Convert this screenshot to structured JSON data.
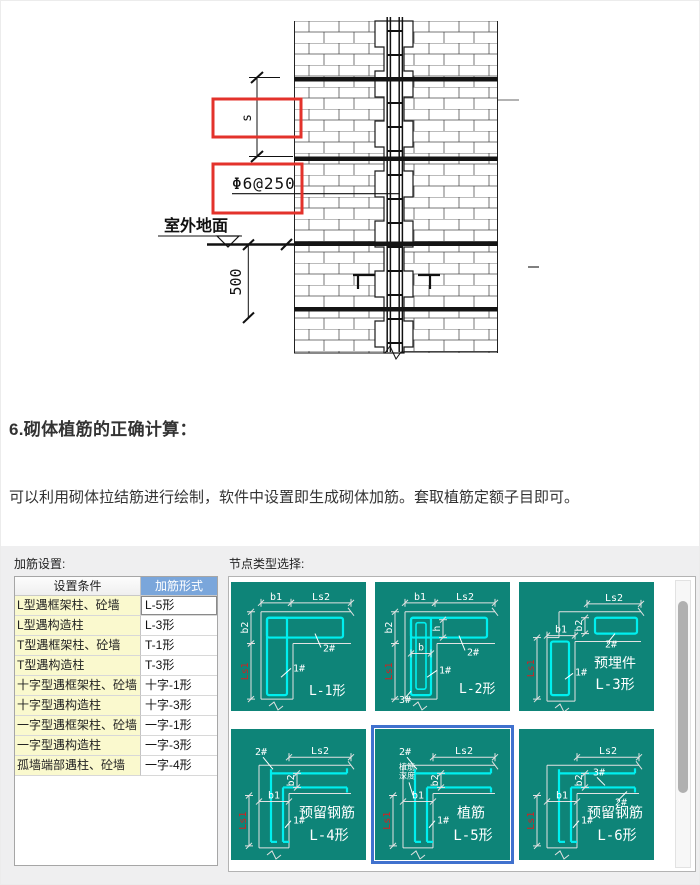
{
  "heading": "6.砌体植筋的正确计算：",
  "paragraph": "可以利用砌体拉结筋进行绘制，软件中设置即生成砌体加筋。套取植筋定额子目即可。",
  "drawing": {
    "labels": {
      "s": "s",
      "phi": "Φ6@250",
      "ground": "室外地面",
      "dim500": "500"
    },
    "highlight_color": "#e3322b"
  },
  "settings_panel": {
    "title": "加筋设置:",
    "table": {
      "headers": [
        "设置条件",
        "加筋形式"
      ],
      "rows": [
        {
          "condition": "L型遇框架柱、砼墙",
          "form": "L-5形",
          "selected": true
        },
        {
          "condition": "L型遇构造柱",
          "form": "L-3形",
          "selected": false
        },
        {
          "condition": "T型遇框架柱、砼墙",
          "form": "T-1形",
          "selected": false
        },
        {
          "condition": "T型遇构造柱",
          "form": "T-3形",
          "selected": false
        },
        {
          "condition": "十字型遇框架柱、砼墙",
          "form": "十字-1形",
          "selected": false
        },
        {
          "condition": "十字型遇构造柱",
          "form": "十字-3形",
          "selected": false
        },
        {
          "condition": "一字型遇框架柱、砼墙",
          "form": "一字-1形",
          "selected": false
        },
        {
          "condition": "一字型遇构造柱",
          "form": "一字-3形",
          "selected": false
        },
        {
          "condition": "孤墙端部遇柱、砼墙",
          "form": "一字-4形",
          "selected": false
        }
      ]
    }
  },
  "node_panel": {
    "title": "节点类型选择:",
    "colors": {
      "teal": "#0e8478",
      "rebar": "#00efef",
      "line": "#e2e2e2",
      "red_dim": "#d42020",
      "selection": "#4071ce"
    },
    "cells": [
      {
        "id": "L-1",
        "variant": "closed",
        "caption": "L-1形",
        "caption2": "",
        "dim_b1": "b1",
        "dim_ls2": "Ls2",
        "dim_b2": "b2",
        "dim_ls1": "Ls1",
        "tag1": "1#",
        "tag2": "2#",
        "selected": false
      },
      {
        "id": "L-2",
        "variant": "closed2",
        "caption": "L-2形",
        "caption2": "",
        "dim_b1": "b1",
        "dim_ls2": "Ls2",
        "dim_b2": "b2",
        "dim_ls1": "Ls1",
        "dim_b": "b",
        "dim_h": "h",
        "tag1": "1#",
        "tag2": "2#",
        "tag3": "3#",
        "selected": false
      },
      {
        "id": "L-3",
        "variant": "separate",
        "caption": "L-3形",
        "caption2": "预埋件",
        "dim_b1": "b1",
        "dim_ls2": "Ls2",
        "dim_b2": "b2",
        "dim_ls1": "Ls1",
        "tag1": "1#",
        "tag2": "2#",
        "selected": false
      },
      {
        "id": "L-4",
        "variant": "open",
        "caption": "L-4形",
        "caption2": "预留钢筋",
        "dim_b1": "b1",
        "dim_ls2": "Ls2",
        "dim_b2": "b2",
        "dim_ls1": "Ls1",
        "tag1": "1#",
        "tag2": "2#",
        "selected": false
      },
      {
        "id": "L-5",
        "variant": "open",
        "caption": "L-5形",
        "caption2": "植筋",
        "note_line1": "植筋",
        "note_line2": "深度",
        "dim_b1": "b1",
        "dim_ls2": "Ls2",
        "dim_b2": "b2",
        "dim_ls1": "Ls1",
        "tag1": "1#",
        "tag2": "2#",
        "selected": true
      },
      {
        "id": "L-6",
        "variant": "open",
        "caption": "L-6形",
        "caption2": "预留钢筋",
        "dim_b1": "b1",
        "dim_ls2": "Ls2",
        "dim_b2": "b2",
        "dim_ls1": "Ls1",
        "tag1": "1#",
        "tag2": "2#",
        "tag3": "3#",
        "selected": false
      }
    ]
  }
}
